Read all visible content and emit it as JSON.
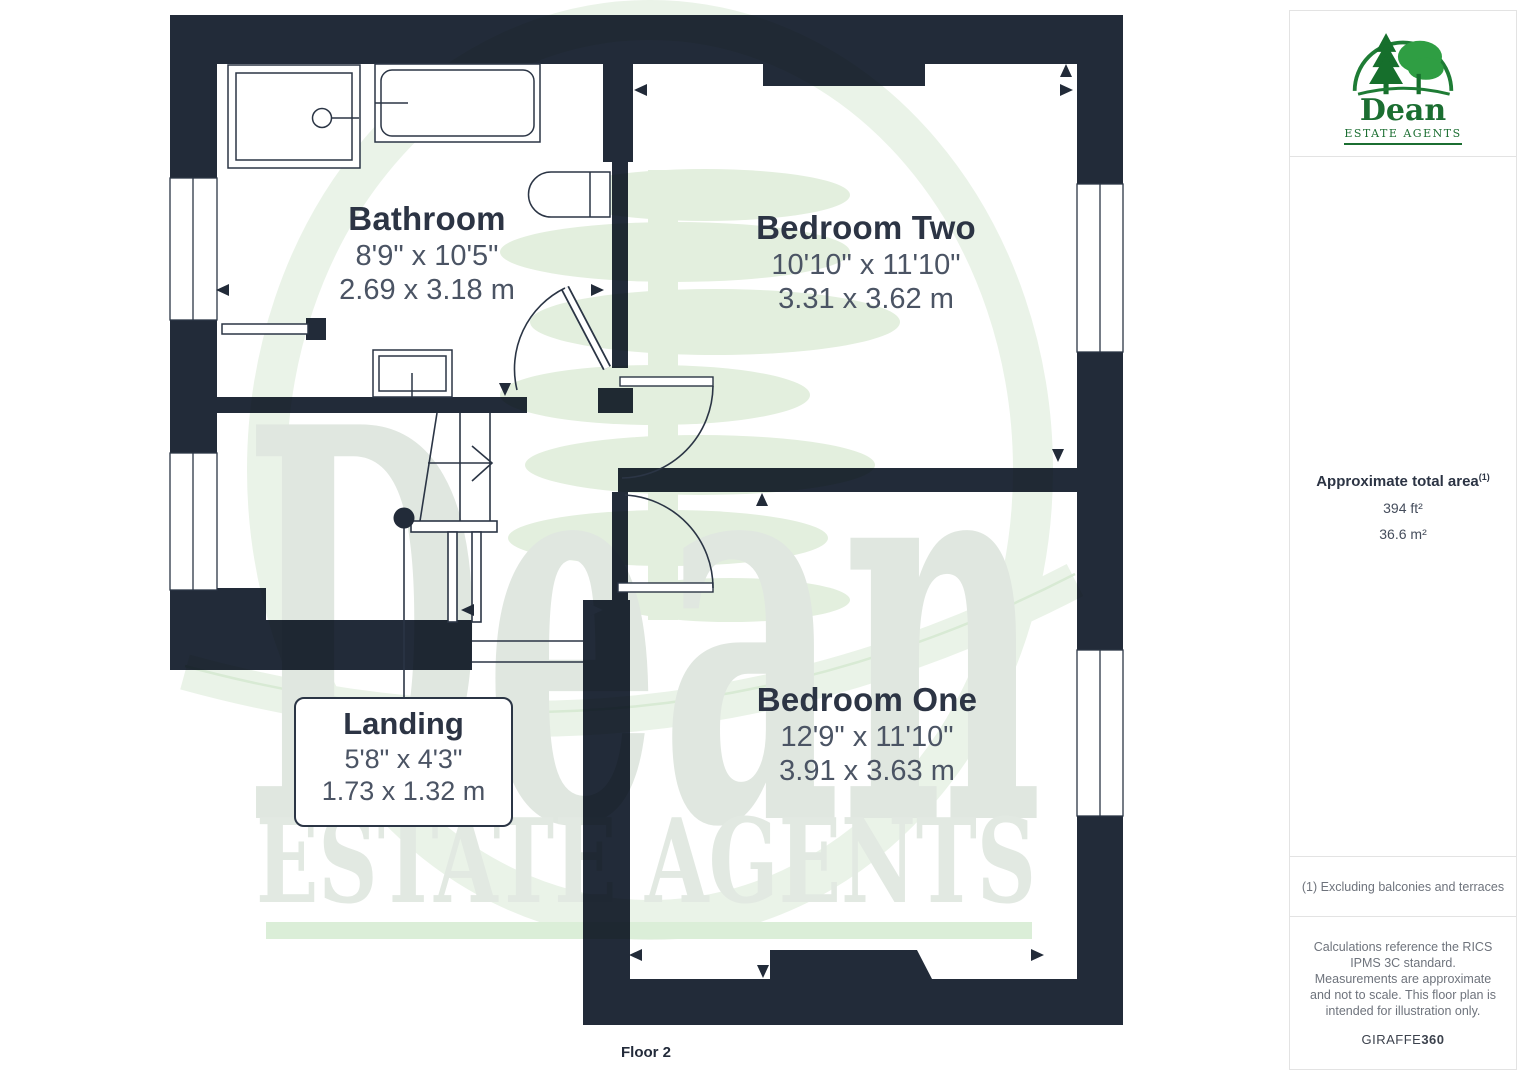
{
  "plan": {
    "floor_label": "Floor 2",
    "rooms": {
      "bathroom": {
        "name": "Bathroom",
        "imperial": "8'9\" x 10'5\"",
        "metric": "2.69 x 3.18 m"
      },
      "bedroom_two": {
        "name": "Bedroom Two",
        "imperial": "10'10\" x 11'10\"",
        "metric": "3.31 x 3.62 m"
      },
      "bedroom_one": {
        "name": "Bedroom One",
        "imperial": "12'9\" x 11'10\"",
        "metric": "3.91 x 3.63 m"
      },
      "landing": {
        "name": "Landing",
        "imperial": "5'8\" x 4'3\"",
        "metric": "1.73 x 1.32 m"
      }
    },
    "watermark": {
      "word": "Dean",
      "tagline": "ESTATE AGENTS"
    }
  },
  "sidebar": {
    "logo": {
      "word": "Dean",
      "tagline": "ESTATE AGENTS"
    },
    "area": {
      "title": "Approximate total area",
      "footnote_ref": "(1)",
      "imperial": "394 ft²",
      "metric": "36.6 m²"
    },
    "footnote": "(1) Excluding balconies and terraces",
    "disclaimer": "Calculations reference the RICS IPMS 3C standard. Measurements are approximate and not to scale. This floor plan is intended for illustration only.",
    "brand": {
      "name": "GIRAFFE",
      "suffix": "360"
    }
  },
  "colors": {
    "wall": "#222b39",
    "line": "#2b3545",
    "logo_green": "#1b6e31",
    "text_dark": "#2c3444",
    "text_dim": "#4b5464",
    "watermark_gray": "#e0e7e0",
    "watermark_green": "#eaf3e8"
  }
}
